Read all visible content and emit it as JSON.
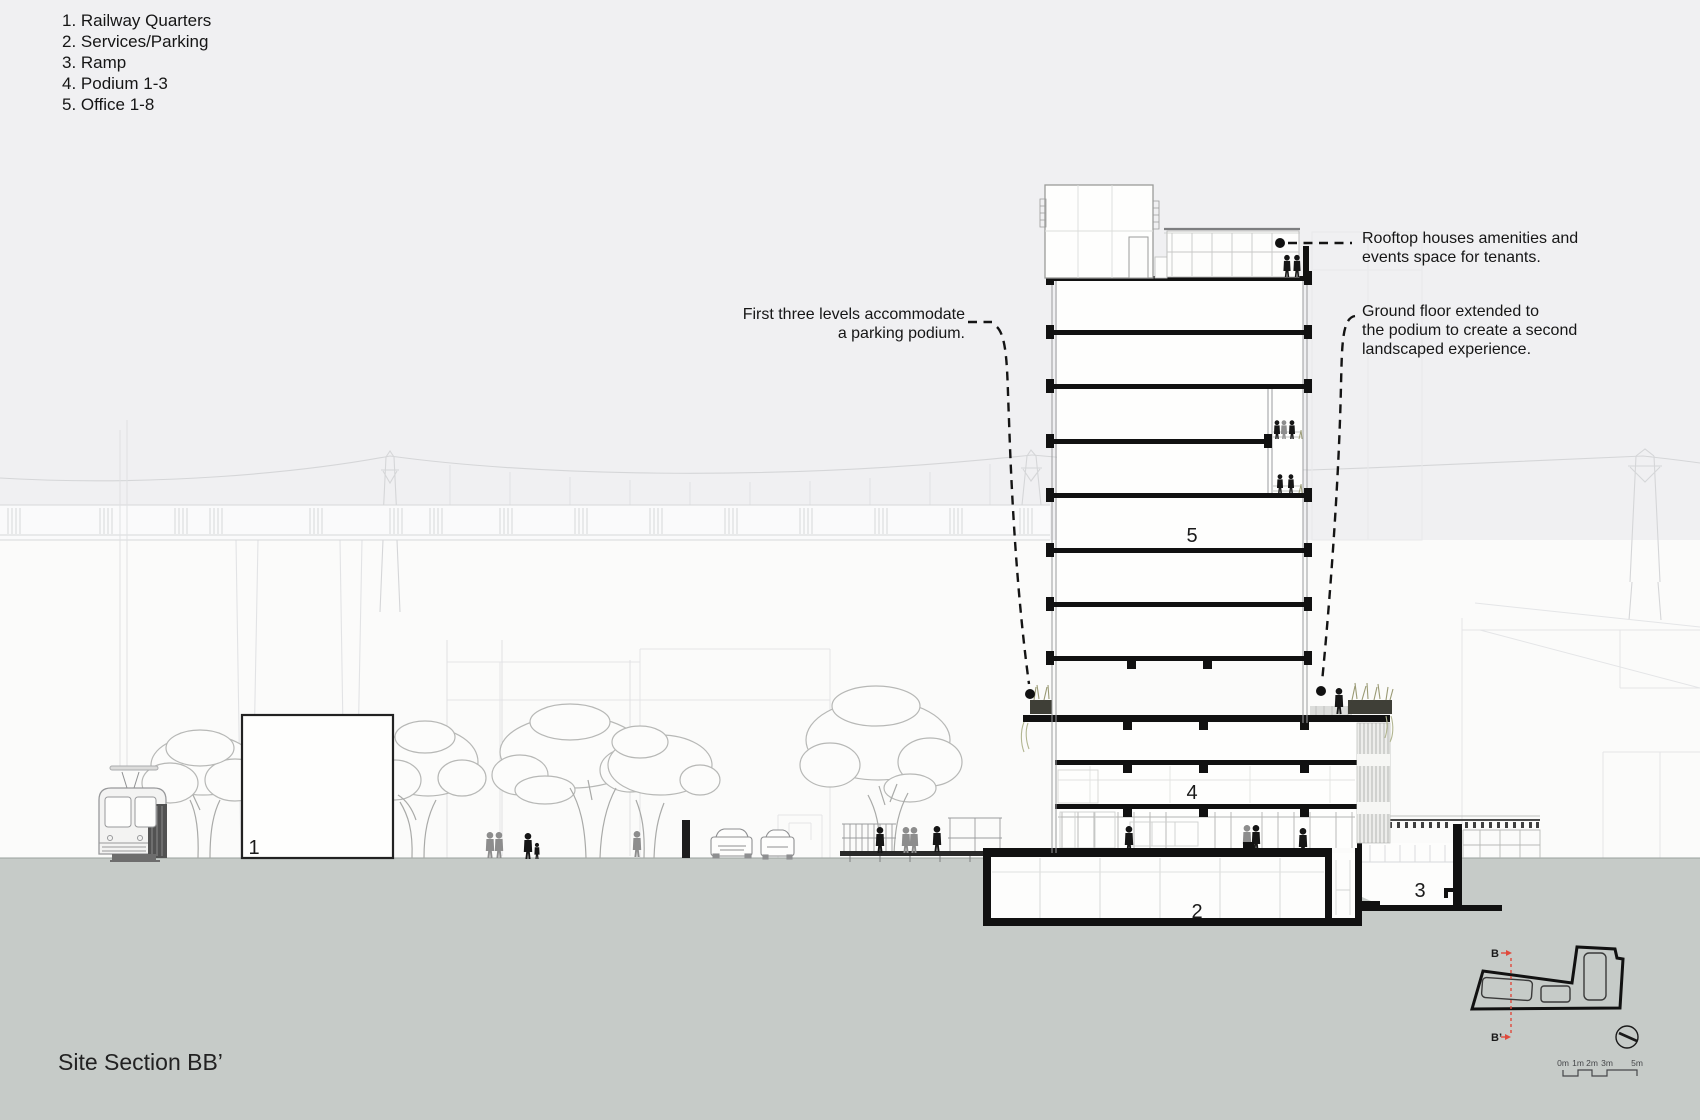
{
  "legend": {
    "items": [
      "1. Railway Quarters",
      "2. Services/Parking",
      "3. Ramp",
      "4. Podium 1-3",
      "5. Office 1-8"
    ]
  },
  "annotations": {
    "parking_podium": {
      "line1": "First three levels accommodate",
      "line2": "a parking podium."
    },
    "rooftop": {
      "line1": "Rooftop houses amenities and",
      "line2": "events space for tenants."
    },
    "ground_floor": {
      "line1": "Ground floor extended to",
      "line2": "the podium to create a second",
      "line3": "landscaped experience."
    }
  },
  "section_labels": {
    "railway_quarters": "1",
    "services_parking": "2",
    "ramp": "3",
    "podium": "4",
    "office": "5"
  },
  "title": "Site Section BB’",
  "key_plan": {
    "section_start": "B",
    "section_end": "B’"
  },
  "scale_bar": {
    "labels": [
      "0m",
      "1m",
      "2m",
      "3m",
      "5m"
    ]
  },
  "colors": {
    "ground": "#c6cbc8",
    "sky": "#f0f0f2",
    "section_line_red": "#e04a3c",
    "ink": "#161616"
  }
}
